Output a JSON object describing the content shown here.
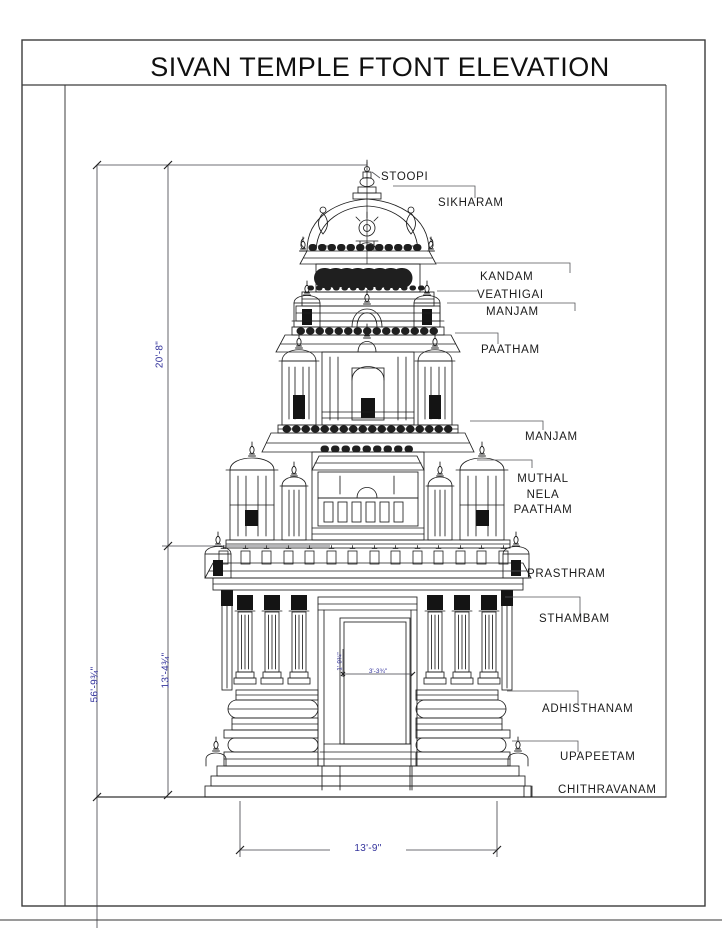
{
  "title": "SIVAN TEMPLE FTONT ELEVATION",
  "labels": {
    "stoopi": "STOOPI",
    "sikharam": "SIKHARAM",
    "kandam": "KANDAM",
    "veathigai": "VEATHIGAI",
    "manjam_upper": "MANJAM",
    "paatham": "PAATHAM",
    "manjam_lower": "MANJAM",
    "muthal_line1": "MUTHAL",
    "muthal_line2": "NELA",
    "muthal_line3": "PAATHAM",
    "prasthram": "PRASTHRAM",
    "sthambam": "STHAMBAM",
    "adhisthanam": "ADHISTHANAM",
    "upapeetam": "UPAPEETAM",
    "chithravanam": "CHITHRAVANAM"
  },
  "dimensions": {
    "upper_height": "20'-8\"",
    "lower_height": "13'-4¾\"",
    "total_height": "56'-9¾\"",
    "base_width": "13'-9\"",
    "door_width": "3'-3¾\"",
    "door_height": "1'-9¾\""
  },
  "colors": {
    "line": "#1f1f1f",
    "dimension_text": "#34349c",
    "border": "#3c3c3c"
  }
}
